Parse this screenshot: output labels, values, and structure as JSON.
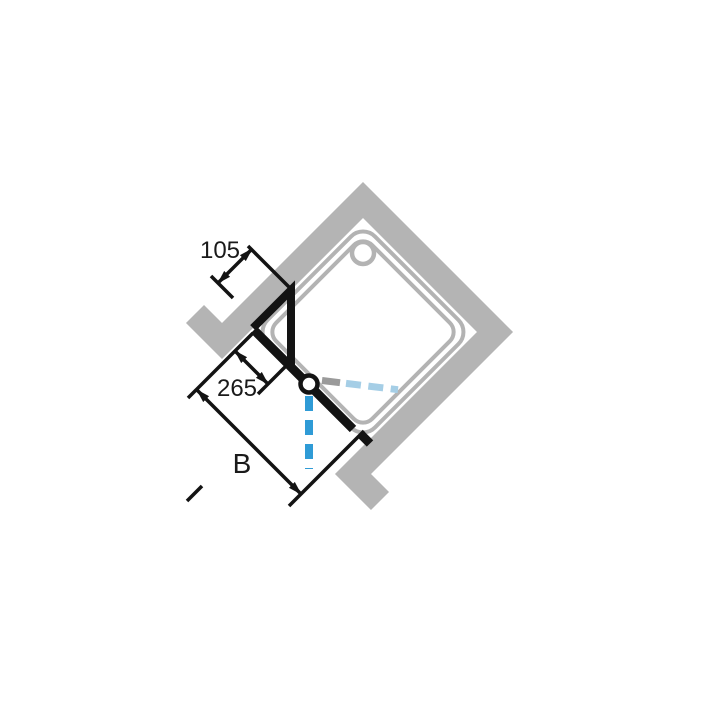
{
  "figure": {
    "kind": "shower-enclosure-corner-plan-drawing",
    "labels": {
      "dim_panel": "105",
      "dim_hinge": "265",
      "dim_width": "B"
    },
    "colors": {
      "background": "#ffffff",
      "wall": "#b4b4b4",
      "tray_outline": "#b3b3b3",
      "drawing_black": "#131313",
      "swing_outward_blue": "#2f9bd6",
      "swing_inward_blue": "#a5cee6",
      "swing_inward_gray": "#9a9a9a",
      "dimension_text": "#1a1a1a"
    }
  }
}
